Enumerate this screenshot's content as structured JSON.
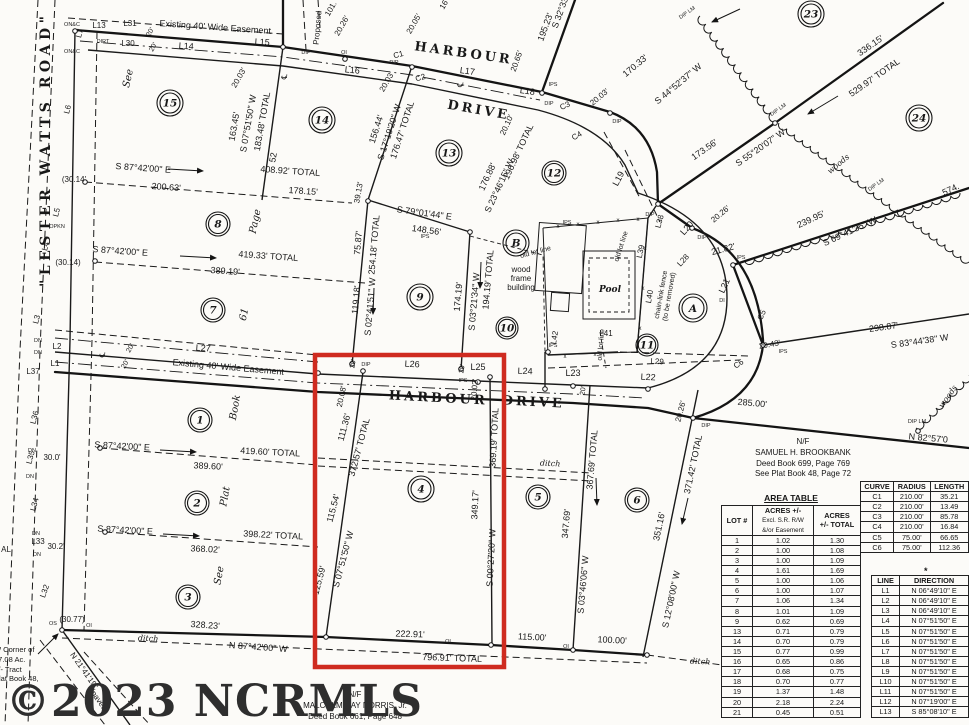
{
  "watermark": "©2023 NCRMLS",
  "roads": {
    "lester": "\"LESTER WATTS ROAD\"",
    "harbour": "HARBOUR",
    "drive": "DRIVE"
  },
  "lots": {
    "n1": "1",
    "n2": "2",
    "n3": "3",
    "n4": "4",
    "n5": "5",
    "n6": "6",
    "n7": "7",
    "n8": "8",
    "n9": "9",
    "n10": "10",
    "n11": "11",
    "n12": "12",
    "n13": "13",
    "n14": "14",
    "n15": "15",
    "n23": "23",
    "n24": "24",
    "A": "A",
    "B": "B"
  },
  "markers": {
    "dip": "DIP",
    "ips": "IPS",
    "oi": "OI",
    "di": "DI",
    "dn": "DN",
    "onc": "ON&C",
    "os": "OS",
    "opkn": "OPKN",
    "dirt": "DIRT",
    "diplm": "DIP LM",
    "x": "x",
    "cl": "℄"
  },
  "labels": {
    "easement_top": "Existing 40' Wide Easement",
    "easement_low": "Existing 40' Wide Easement",
    "l13t": "L13",
    "l31": "L31",
    "l30": "L30",
    "l14": "L14",
    "l15": "L15",
    "l16": "L16",
    "l17": "L17",
    "l18": "L18",
    "l19": "L19",
    "l20": "L20",
    "l21": "L21",
    "l22": "L22",
    "l23": "L23",
    "l24": "L24",
    "l25": "L25",
    "l26": "L26",
    "l27": "L27",
    "l28": "L28",
    "l29": "L29",
    "l38": "L38",
    "l39": "L39",
    "l40": "L40",
    "l41": "L41",
    "l42": "L42",
    "l7t": "L7",
    "l6t": "L6",
    "l5t": "L5",
    "l4t": "L4",
    "l3t": "L3",
    "l2t": "L2",
    "l1t": "L1",
    "l37": "L37",
    "l36": "L36",
    "l35": "L35",
    "l34": "L34",
    "l33": "L33",
    "l32": "L32",
    "c1": "C1",
    "c2": "C2",
    "c3": "C3",
    "c4": "C4",
    "c5": "C5",
    "c6": "C6",
    "proposed": "Proposed",
    "p101": "101.",
    "cut16": "16",
    "cutAL": "AL",
    "d2026": "20.26'",
    "d2005": "20.05'",
    "d195": "195.23'",
    "s3233": "S 32°33'",
    "d2065": "20.65'",
    "d2003": "20.03'",
    "d17033": "170.33'",
    "s4452": "S 44°52'37\" W",
    "d33615": "336.15'",
    "d52997": "529.97' TOTAL",
    "s5520": "S 55°20'07\" W",
    "d17356": "173.56'",
    "d2182": "21.82'",
    "d23995": "239.95'",
    "s6941": "S 69°41'35\" W",
    "d574": "574.",
    "woods": "woods",
    "d29887": "298.87'",
    "s8344": "S 83°44'38\" W",
    "d28500": "285.00'",
    "n8257": "N 82°57'0",
    "d2043": "20.43'",
    "s8742": "S 87°42'00\" E",
    "d40892": "408.92' TOTAL",
    "d20063": "200.63'",
    "d17815": "178.15'",
    "d41933": "419.33' TOTAL",
    "d38919": "389.19'",
    "d41960": "419.60' TOTAL",
    "d38960": "389.60'",
    "d39822": "398.22' TOTAL",
    "d36802": "368.02'",
    "d3014a": "(30.14'",
    "d3014b": "(30.14)",
    "d300": "30.0'",
    "d302": "30.2'",
    "d3077": "(30.77)",
    "see": "See",
    "page": "Page",
    "n61": "61",
    "book": "Book",
    "plat": "Plat",
    "n52": "52",
    "d16345": "163.45'",
    "s0751": "S 07°51'50\" W",
    "d18348": "183.48' TOTAL",
    "d15644": "156.44'",
    "s1719": "S 17°19'20\" W",
    "d17647": "176.47' TOTAL",
    "s7901": "S 79°01'44\" E",
    "d14856": "148.56'",
    "d3913": "39.13'",
    "d7587": "75.87'",
    "d25418": "254.18' TOTAL",
    "d11918": "119.18'",
    "s0241": "S 02°41'51\" W",
    "d17419": "174.19'",
    "s0321": "S 03°21'34\" W",
    "d19419": "194.19' TOTAL",
    "d17688": "176.88'",
    "s2346": "S 23°46'15\" W",
    "d19698": "196.98' TOTAL",
    "d2010": "20.10'",
    "oldlot": "old lot line",
    "wood1": "wood",
    "wood2": "frame",
    "wood3": "building",
    "pool": "Pool",
    "chain1": "chain-link fence",
    "chain2": "(to be removed)",
    "d2008": "20.08'",
    "d2002": "20.02'",
    "d20": "20'",
    "d11136": "111.36'",
    "d37257": "372.57' TOTAL",
    "d11554": "115.54'",
    "d12559": "125.59'",
    "d36919": "369.19' TOTAL",
    "d34917": "349.17'",
    "s0027": "S 00°27'20\" W",
    "d22291": "222.91'",
    "d79691": "796.91' TOTAL",
    "d11500": "115.00'",
    "d10000": "100.00'",
    "n8742": "N 87°42'00\" W",
    "d32823": "328.23'",
    "d34769": "347.69'",
    "d36769": "367.69' TOTAL",
    "s0346": "S 03°46'06\" W",
    "d35116": "351.16'",
    "d37142": "371.42' TOTAL",
    "s1208": "S 12°08'00\" W",
    "ditch": "ditch",
    "n2141": "N 21°41'19\"",
    "paved": "(paved)"
  },
  "notes": {
    "brookbank": [
      "N/F",
      "SAMUEL H. BROOKBANK",
      "Deed Book 699, Page 769",
      "See Plat Book 48, Page 72"
    ],
    "norris": [
      "N/F",
      "MALCOLM RAY NORRIS, Jr.",
      "Deed Book 661, Page 648"
    ],
    "corner": [
      "W Corner of",
      "37.08 Ac.",
      "+/- Tract",
      "Plat Book 48,"
    ]
  },
  "area_table": {
    "title": "AREA TABLE",
    "col_lot": "LOT #",
    "col_excl": [
      "ACRES +/-",
      "Excl. S.R. R/W",
      "&/or Easement"
    ],
    "col_total": [
      "ACRES",
      "+/- TOTAL"
    ],
    "rows": [
      [
        "1",
        "1.02",
        "1.30"
      ],
      [
        "2",
        "1.00",
        "1.08"
      ],
      [
        "3",
        "1.00",
        "1.09"
      ],
      [
        "4",
        "1.61",
        "1.69"
      ],
      [
        "5",
        "1.00",
        "1.06"
      ],
      [
        "6",
        "1.00",
        "1.07"
      ],
      [
        "7",
        "1.06",
        "1.34"
      ],
      [
        "8",
        "1.01",
        "1.09"
      ],
      [
        "9",
        "0.62",
        "0.69"
      ],
      [
        "13",
        "0.71",
        "0.79"
      ],
      [
        "14",
        "0.70",
        "0.79"
      ],
      [
        "15",
        "0.77",
        "0.99"
      ],
      [
        "16",
        "0.65",
        "0.86"
      ],
      [
        "17",
        "0.68",
        "0.75"
      ],
      [
        "18",
        "0.70",
        "0.77"
      ],
      [
        "19",
        "1.37",
        "1.48"
      ],
      [
        "20",
        "2.18",
        "2.24"
      ],
      [
        "21",
        "0.45",
        "0.51"
      ]
    ]
  },
  "curve_table": {
    "headers": [
      "CURVE",
      "RADIUS",
      "LENGTH"
    ],
    "rows": [
      [
        "C1",
        "210.00'",
        "35.21"
      ],
      [
        "C2",
        "210.00'",
        "13.49"
      ],
      [
        "C3",
        "210.00'",
        "85.78"
      ],
      [
        "C4",
        "210.00'",
        "16.84"
      ],
      [
        "C5",
        "75.00'",
        "66.65"
      ],
      [
        "C6",
        "75.00'",
        "112.36"
      ]
    ]
  },
  "line_table": {
    "star": "*",
    "headers": [
      "LINE",
      "DIRECTION"
    ],
    "rows": [
      [
        "L1",
        "N 06°49'10\" E"
      ],
      [
        "L2",
        "N 06°49'10\" E"
      ],
      [
        "L3",
        "N 06°49'10\" E"
      ],
      [
        "L4",
        "N 07°51'50\" E"
      ],
      [
        "L5",
        "N 07°51'50\" E"
      ],
      [
        "L6",
        "N 07°51'50\" E"
      ],
      [
        "L7",
        "N 07°51'50\" E"
      ],
      [
        "L8",
        "N 07°51'50\" E"
      ],
      [
        "L9",
        "N 07°51'50\" E"
      ],
      [
        "L10",
        "N 07°51'50\" E"
      ],
      [
        "L11",
        "N 07°51'50\" E"
      ],
      [
        "L12",
        "N 07°19'00\" E"
      ],
      [
        "L13",
        "S 85°08'10\" E"
      ]
    ]
  },
  "highlight": {
    "color": "#cf2b20"
  }
}
